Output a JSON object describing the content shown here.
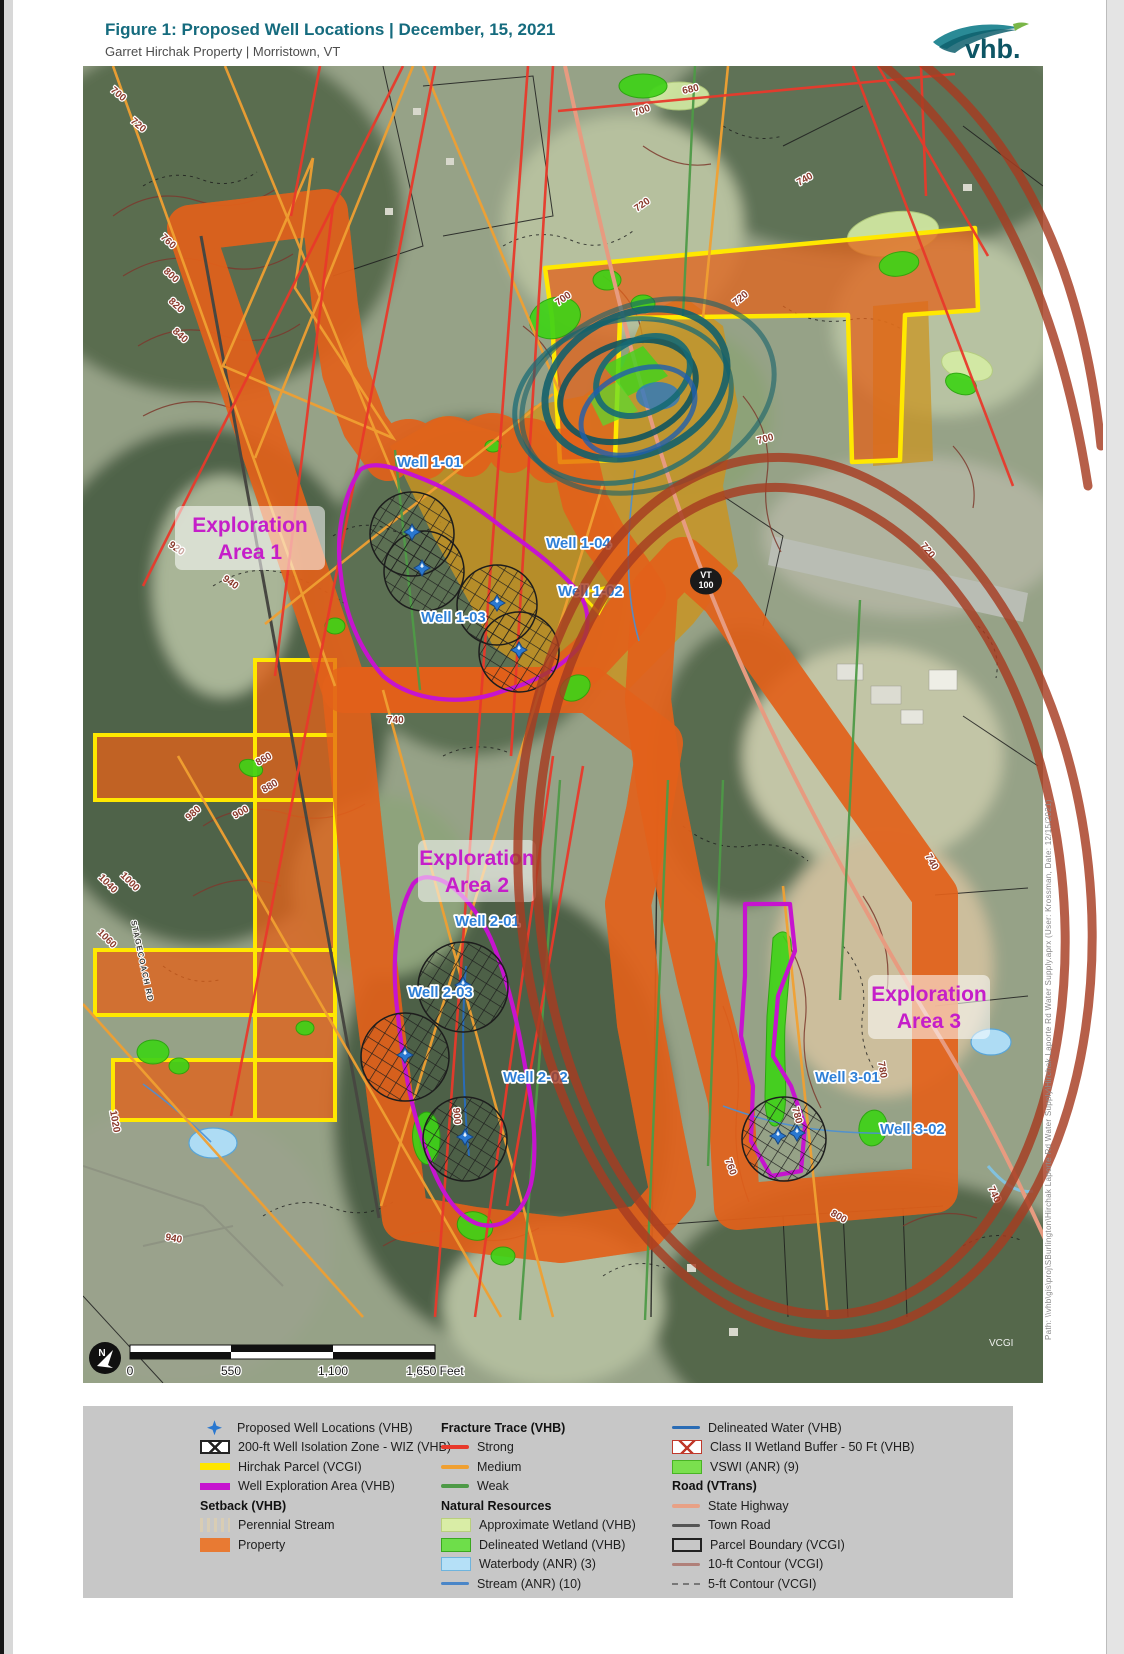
{
  "page": {
    "title": "Figure 1: Proposed Well Locations | December, 15, 2021",
    "subtitle": "Garret Hirchak Property | Morristown, VT",
    "brand": "vhb.",
    "side_note": "Path: \\\\vhb\\gis\\proj\\SBurlington\\Hirchak Laporte Rd Water Supply\\Hirchak Laporte Rd Water Supply.aprx (User: Krossman, Date: 12/15/2021)",
    "colors": {
      "title_teal": "#156b7e",
      "parcel_yellow": "#ffe800",
      "exploration_magenta": "#c614cf",
      "property_orange": "#e2611a",
      "fracture_strong": "#e8392b",
      "fracture_medium": "#f0a032",
      "fracture_weak": "#4e9a47",
      "well_blue": "#2a78d0"
    }
  },
  "map": {
    "wells": [
      "Well 1-01",
      "Well 1-03",
      "Well 1-04",
      "Well 1-02",
      "Well 2-01",
      "Well 2-03",
      "Well 2-02",
      "Well 3-01",
      "Well 3-02"
    ],
    "areas": [
      {
        "line1": "Exploration",
        "line2": "Area 1"
      },
      {
        "line1": "Exploration",
        "line2": "Area 2"
      },
      {
        "line1": "Exploration",
        "line2": "Area 3"
      }
    ],
    "route_shield": {
      "state": "VT",
      "number": "100"
    },
    "road_label": "STAGECOACH RD",
    "north_label": "N",
    "attribution": "VCGI",
    "scale_ticks": [
      "0",
      "550",
      "1,100",
      "1,650 Feet"
    ],
    "contours": [
      "700",
      "720",
      "680",
      "700",
      "720",
      "700",
      "720",
      "700",
      "740",
      "720",
      "740",
      "780",
      "780",
      "760",
      "740",
      "800",
      "760",
      "800",
      "820",
      "840",
      "920",
      "940",
      "860",
      "880",
      "900",
      "980",
      "1000",
      "1040",
      "1060",
      "1020",
      "900",
      "940",
      "740"
    ]
  },
  "legend": {
    "col1": [
      {
        "swatch": "well-marker",
        "label": "Proposed Well Locations (VHB)"
      },
      {
        "swatch": "wiz",
        "label": "200-ft Well Isolation Zone - WIZ (VHB)"
      },
      {
        "swatch": "yellow-line",
        "label": "Hirchak Parcel (VCGI)"
      },
      {
        "swatch": "magenta-line",
        "label": "Well Exploration Area (VHB)"
      },
      {
        "header": "Setback (VHB)"
      },
      {
        "swatch": "perennial-stream",
        "label": "Perennial Stream"
      },
      {
        "swatch": "property",
        "label": "Property"
      }
    ],
    "col2": [
      {
        "header": "Fracture Trace (VHB)"
      },
      {
        "swatch": "strong",
        "label": "Strong"
      },
      {
        "swatch": "medium",
        "label": "Medium"
      },
      {
        "swatch": "weak",
        "label": "Weak"
      },
      {
        "header": "Natural Resources"
      },
      {
        "swatch": "approx-wetland",
        "label": "Approximate Wetland (VHB)"
      },
      {
        "swatch": "delineated-wetland",
        "label": "Delineated Wetland (VHB)"
      },
      {
        "swatch": "waterbody",
        "label": "Waterbody (ANR) (3)"
      },
      {
        "swatch": "stream",
        "label": "Stream (ANR) (10)"
      }
    ],
    "col3": [
      {
        "swatch": "delineated-water",
        "label": "Delineated Water (VHB)"
      },
      {
        "swatch": "wetland-buffer",
        "label": "Class II Wetland Buffer - 50 Ft (VHB)"
      },
      {
        "swatch": "vswi",
        "label": "VSWI (ANR) (9)"
      },
      {
        "header": "Road (VTrans)"
      },
      {
        "swatch": "state-highway",
        "label": "State Highway"
      },
      {
        "swatch": "town-road",
        "label": "Town Road"
      },
      {
        "swatch": "parcel-boundary",
        "label": "Parcel Boundary (VCGI)"
      },
      {
        "swatch": "contour-10ft",
        "label": "10-ft Contour (VCGI)"
      },
      {
        "swatch": "contour-5ft",
        "label": "5-ft Contour (VCGI)"
      }
    ]
  }
}
